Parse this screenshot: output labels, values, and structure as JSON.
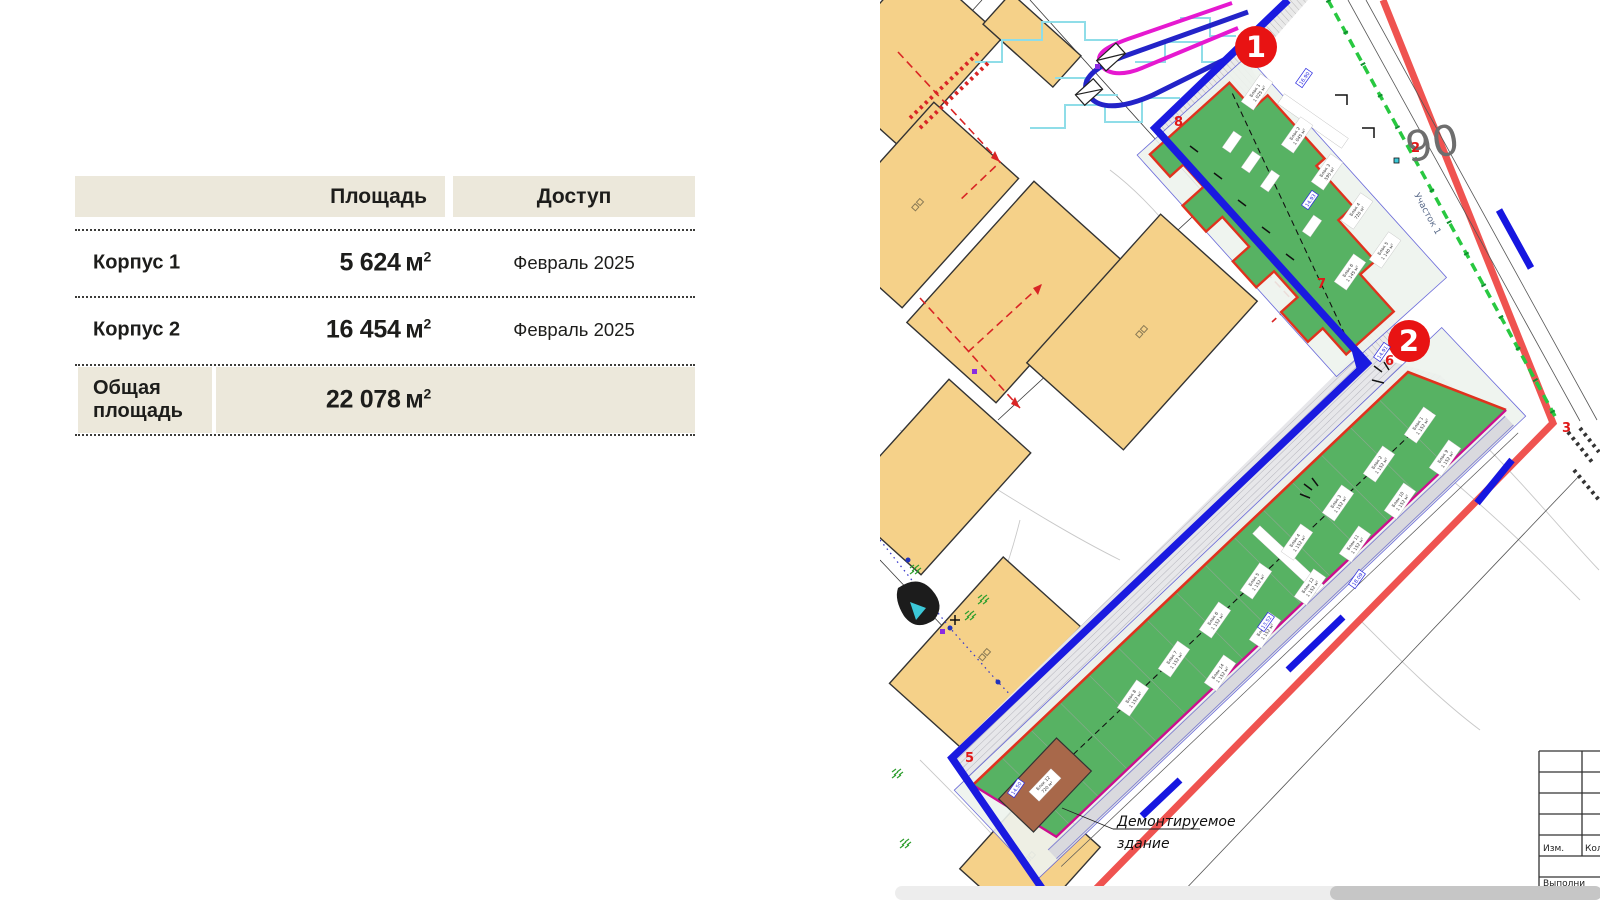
{
  "page": {
    "background": "#ffffff"
  },
  "table": {
    "header_bg": "#ece8db",
    "headers": {
      "area": "Площадь",
      "access": "Доступ"
    },
    "rows": [
      {
        "label": "Корпус 1",
        "value": "5 624",
        "unit": "м",
        "sup": "2",
        "access": "Февраль 2025"
      },
      {
        "label": "Корпус 2",
        "value": "16 454",
        "unit": "м",
        "sup": "2",
        "access": "Февраль 2025"
      },
      {
        "label": "Общая площадь",
        "value": "22 078",
        "unit": "м",
        "sup": "2",
        "access": ""
      }
    ]
  },
  "map": {
    "badges": [
      {
        "n": "1"
      },
      {
        "n": "2"
      }
    ],
    "corner_numbers": [
      {
        "n": "8"
      },
      {
        "n": "7"
      },
      {
        "n": "6"
      },
      {
        "n": "5"
      },
      {
        "n": "3"
      },
      {
        "n": "2"
      }
    ],
    "plot_number": "90",
    "street_label": "Участок 1",
    "demolition_note_line1": "Демонтируемое",
    "demolition_note_line2": "здание",
    "title_block": {
      "c1": "Изм.",
      "c2": "Кол",
      "bottom": "Выполни"
    },
    "k1_blocks": [
      {
        "n": "Блок 1",
        "a": "1 025 м²"
      },
      {
        "n": "Блок 2",
        "a": "1 045 м²"
      },
      {
        "n": "Блок 3",
        "a": "595 м²"
      },
      {
        "n": "Блок 4",
        "a": "720 м²"
      },
      {
        "n": "Блок 5",
        "a": "1 140 м²"
      },
      {
        "n": "Блок 6",
        "a": "1 145 м²"
      }
    ],
    "k2_blocks": [
      {
        "n": "Блок 1",
        "a": "1 152 м²"
      },
      {
        "n": "Блок 2",
        "a": "1 152 м²"
      },
      {
        "n": "Блок 3",
        "a": "1 152 м²"
      },
      {
        "n": "Блок 4",
        "a": "1 152 м²"
      },
      {
        "n": "Блок 5",
        "a": "1 152 м²"
      },
      {
        "n": "Блок 6",
        "a": "1 152 м²"
      },
      {
        "n": "Блок 7",
        "a": "1 152 м²"
      },
      {
        "n": "Блок 8",
        "a": "1 152 м²"
      },
      {
        "n": "Блок 9",
        "a": "1 152 м²"
      },
      {
        "n": "Блок 10",
        "a": "1 152 м²"
      },
      {
        "n": "Блок 11",
        "a": "1 152 м²"
      },
      {
        "n": "Блок 12",
        "a": "1 152 м²"
      },
      {
        "n": "Блок 13",
        "a": "1 152 м²"
      },
      {
        "n": "Блок 14",
        "a": "1 152 м²"
      }
    ],
    "brown_block": {
      "n": "Блок 12",
      "a": "720 м²"
    },
    "dims": [
      "16.90",
      "14.93",
      "14.91",
      "14.50",
      "13.52",
      "18.09"
    ],
    "colors": {
      "site_boundary": "#1a1ae0",
      "parcel_red": "#ef5350",
      "parcel_blue": "#1616e0",
      "green_line": "#28c840",
      "korpus_green": "#57b263",
      "korpus_border": "#e0321e",
      "magenta_line": "#cc0e8e",
      "tan_building": "#f5d189",
      "brown_building": "#a8684a",
      "badge_red": "#e81313"
    }
  }
}
